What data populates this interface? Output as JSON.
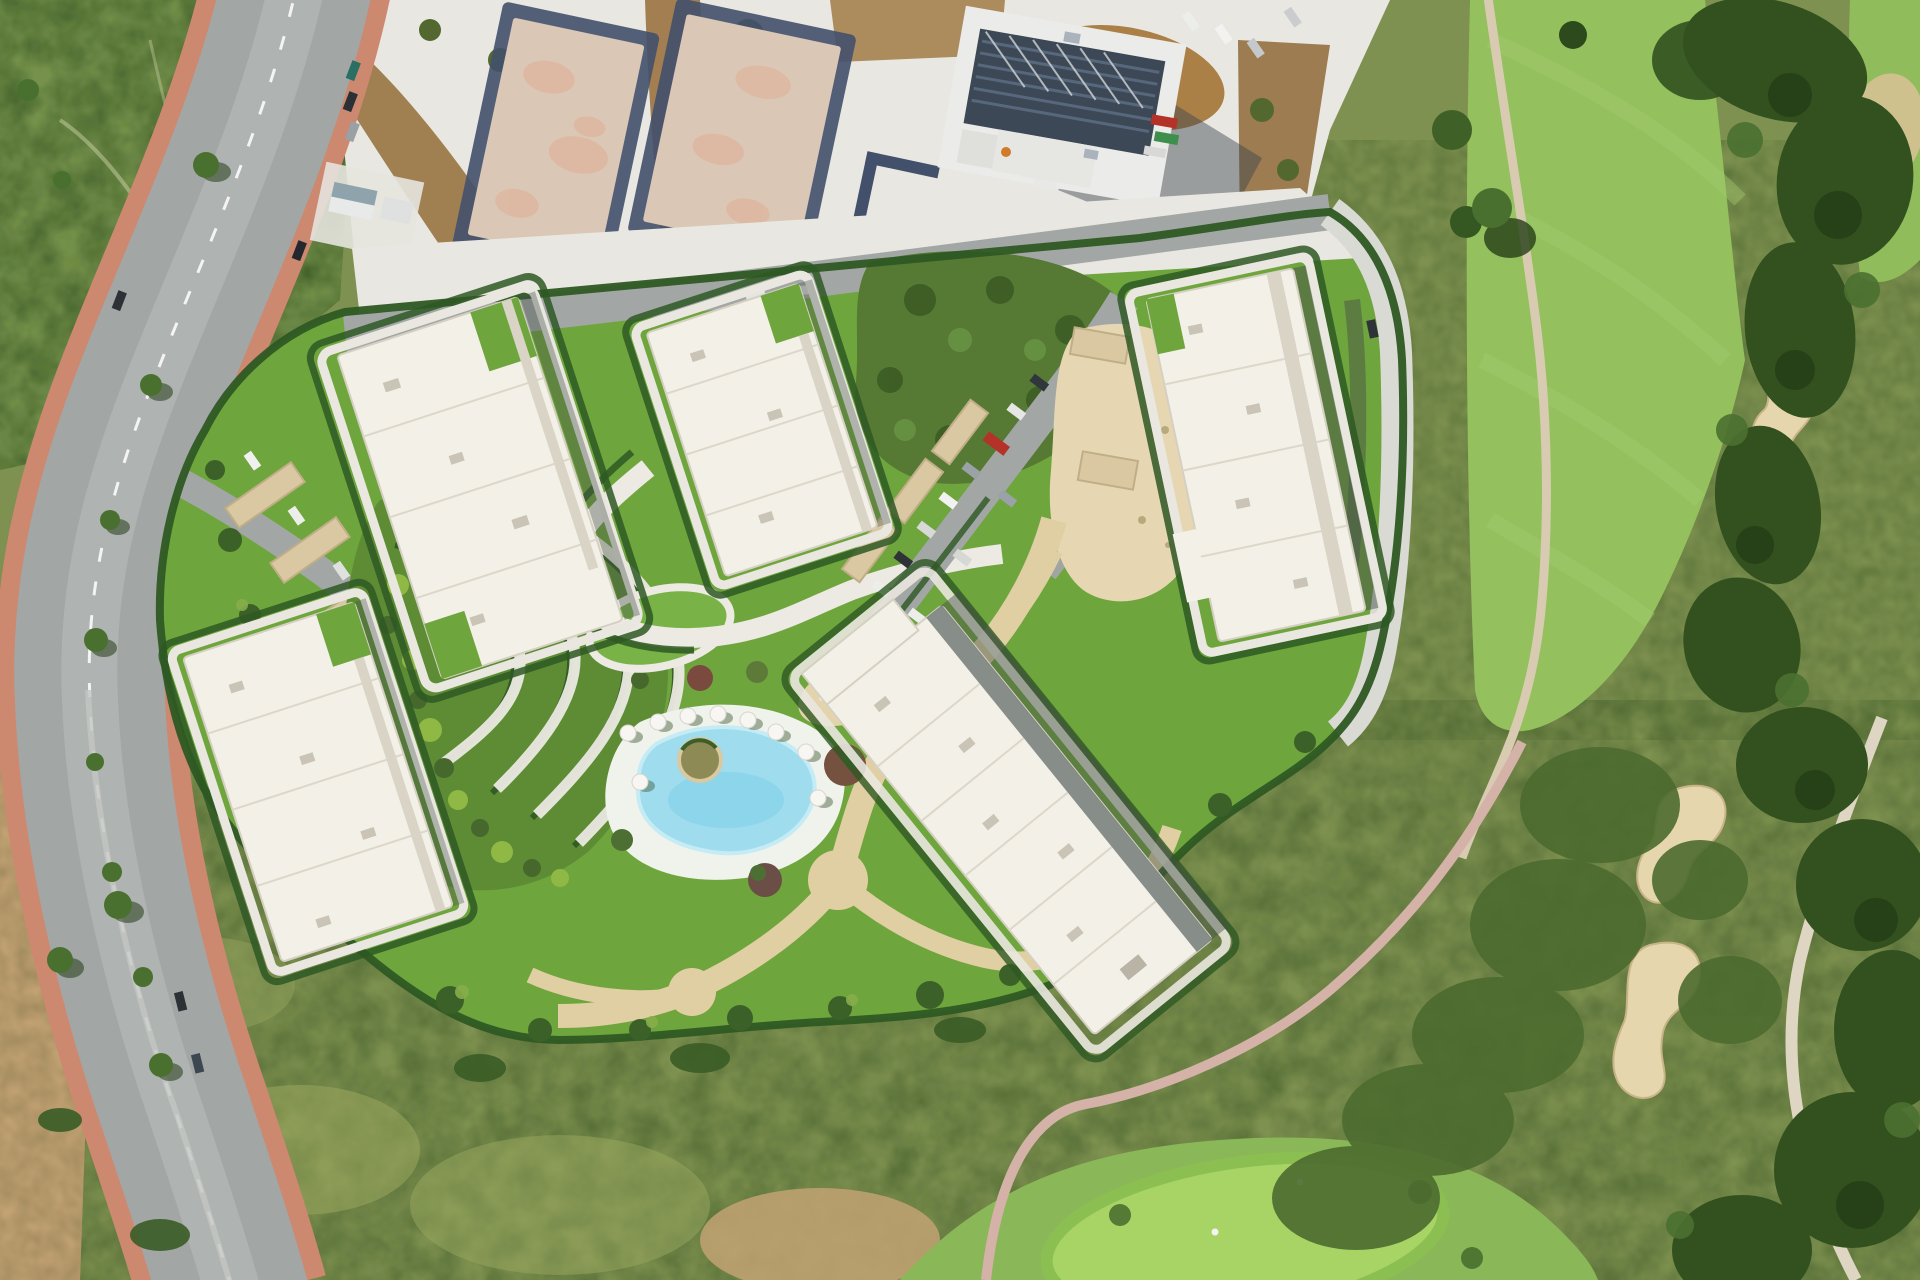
{
  "scene": {
    "type": "aerial-satellite-render",
    "subject": "Aerial masterplan view of a residential apartment development with swimming pool, landscaped gardens and parking, flanked by a perimeter road (left), construction plots (top) and a golf course with sand bunkers (right)",
    "regions": [
      "top-left-scrubland",
      "perimeter-road",
      "construction-zone",
      "residential-complex",
      "terraced-gardens",
      "central-parking",
      "swimming-pool",
      "golf-course",
      "south-scrubland"
    ],
    "counts": {
      "residential_buildings": 5,
      "construction_slabs": 2,
      "golf_bunkers": 3,
      "swimming_pools": 1,
      "pool_parasols": 9,
      "putting_greens": 1,
      "carport_rows": 3
    }
  },
  "colors": {
    "base_olive": "#7e9150",
    "scrub": "#77894a",
    "scrub_dark": "#3e5626",
    "scrub_light": "#9aa75f",
    "top_left_green": "#75914b",
    "lawn": "#6fa53d",
    "lawn_bright": "#79b347",
    "terrace_green": "#5d8c35",
    "hedge": "#2e5823",
    "tree_dark": "#32511f",
    "tree_mid": "#4a7030",
    "tree_light": "#8fb944",
    "woods": "#567934",
    "fairway": "#94c05e",
    "fairway_stripe": "#a5cd70",
    "putting_green": "#a8d465",
    "green_fringe": "#8cbf52",
    "sand_bunker": "#e6d6ae",
    "sand_edge": "#c9b488",
    "cart_path": "#d9cbb2",
    "pink_path": "#d4b2a8",
    "white_path": "#eceae2",
    "tan_path": "#e0cfa2",
    "plaza_tan": "#e6d7b2",
    "asphalt": "#a2a7a5",
    "asphalt_light": "#b9bdbb",
    "sidewalk_red": "#cd8870",
    "lane_line": "#ffffff",
    "gravel": "#e9e7e1",
    "dirt": "#a08050",
    "dirt_light": "#c2a273",
    "slab_concrete": "#dac7b6",
    "slab_mottle": "#e0ad92",
    "trench_blue": "#42506b",
    "construction_roof": "#3d4856",
    "solar_stripe": "#57677c",
    "white_wall": "#eaeae8",
    "roof_white": "#f3f0e8",
    "roof_edge": "#d5d0c2",
    "facade_shade": "#d9d4c6",
    "glass_band": "#6b7570",
    "building_shadow": "#48524a",
    "deck_white": "#f0f2ec",
    "pool_water": "#9edcee",
    "pool_deep": "#7fd0e8",
    "pool_rim": "#c5ecf5",
    "carport": "#d9c8a2",
    "carport_edge": "#bfae86",
    "car_red": "#b43228",
    "car_dark": "#2b3036",
    "car_white": "#eceeea",
    "car_teal": "#2a6f63",
    "shadow_green": "#3f5a33"
  }
}
